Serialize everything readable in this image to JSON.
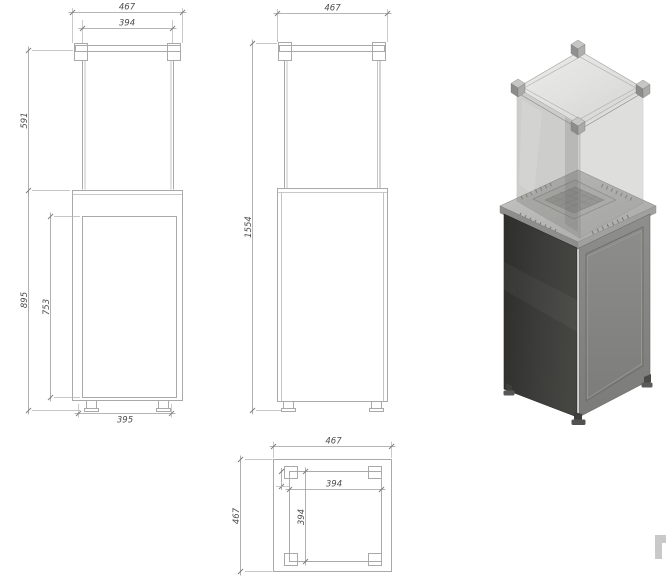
{
  "background": "#ffffff",
  "drawing": {
    "line_color": "#a9a9a9",
    "dim_line_color": "#9c9c9c",
    "text_color": "#4d4d4d",
    "front_view": {
      "overall_width": "467",
      "glass_width": "394",
      "glass_height": "591",
      "base_height": "895",
      "door_height": "753",
      "foot_spacing": "395"
    },
    "side_view": {
      "overall_depth": "467",
      "overall_height": "1554"
    },
    "plan_view": {
      "overall_width": "467",
      "overall_depth": "467",
      "glass_width": "394",
      "glass_depth": "394"
    }
  },
  "render": {
    "body_dark_color": "#383836",
    "body_light_color": "#828280",
    "plate_color": "#b7b7b5",
    "burner_color": "#939391",
    "glass_left_color": "#8a8a86",
    "glass_right_color": "#9c9c9a",
    "glass_top_color": "#e4e4e2",
    "bracket_color": "#c6c6c4",
    "foot_color": "#3e3e3c"
  },
  "watermark": {
    "shape": "gamma-fragment",
    "color": "#c9c9c9"
  }
}
